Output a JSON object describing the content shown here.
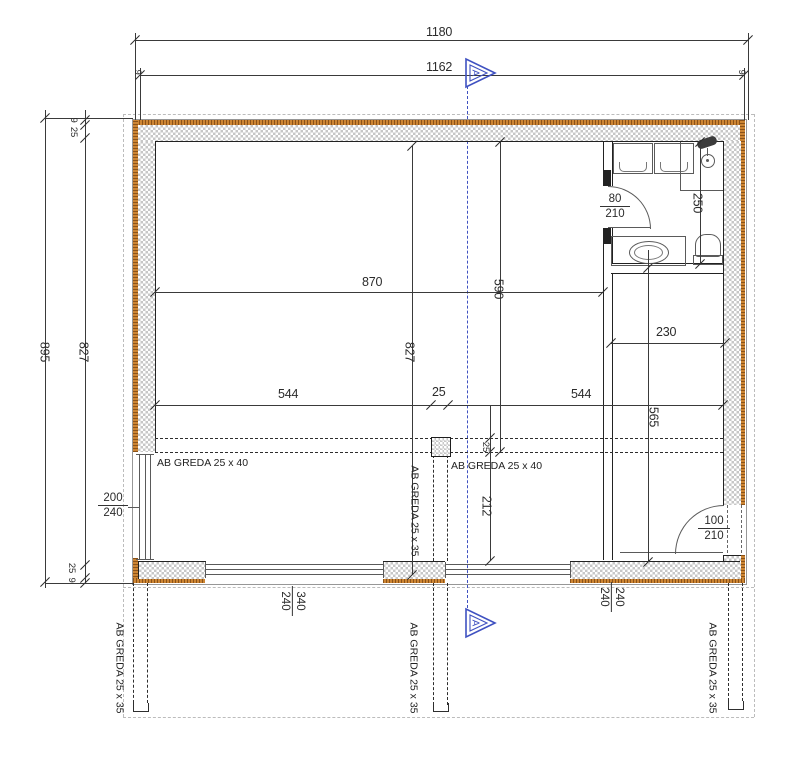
{
  "drawing": {
    "section_marker": "A"
  },
  "dims": {
    "overall_width": "1180",
    "clear_width": "1162",
    "overall_height": "895",
    "inner_height": "827",
    "inner_height_mid": "827",
    "room_width": "870",
    "room_height_to_beam": "590",
    "span_left": "544",
    "column_width": "25",
    "span_right": "544",
    "beam_width": "25",
    "beam_to_wall": "212",
    "right_room_height": "565",
    "right_room_width": "230",
    "bath_depth": "250",
    "layer_9_top": "9",
    "layer_25_top": "25",
    "layer_25_bottom": "25",
    "layer_9_bottom": "9",
    "layer_9_left_end": "9",
    "layer_9_right_end": "9"
  },
  "openings": {
    "left_window": {
      "w": "200",
      "h": "240"
    },
    "bath_door": {
      "w": "80",
      "h": "210"
    },
    "entry_door": {
      "w": "100",
      "h": "210"
    },
    "bottom_window_left": {
      "w": "340",
      "h": "240"
    },
    "bottom_window_right": {
      "w": "240",
      "h": "240"
    }
  },
  "beams": {
    "horizontal_left": "AB GREDA 25 x 40",
    "horizontal_right": "AB GREDA 25 x 40",
    "vertical_center": "AB GREDA 25 x 35",
    "vertical_bottom_left": "AB GREDA 25 x 35",
    "vertical_bottom_center": "AB GREDA 25 x 35",
    "vertical_bottom_right": "AB GREDA 25 x 35"
  },
  "colors": {
    "insulation": "#cd8533",
    "section_line": "#3f51c1",
    "line": "#3a3a3a",
    "hatch": "#c7c7c7"
  }
}
